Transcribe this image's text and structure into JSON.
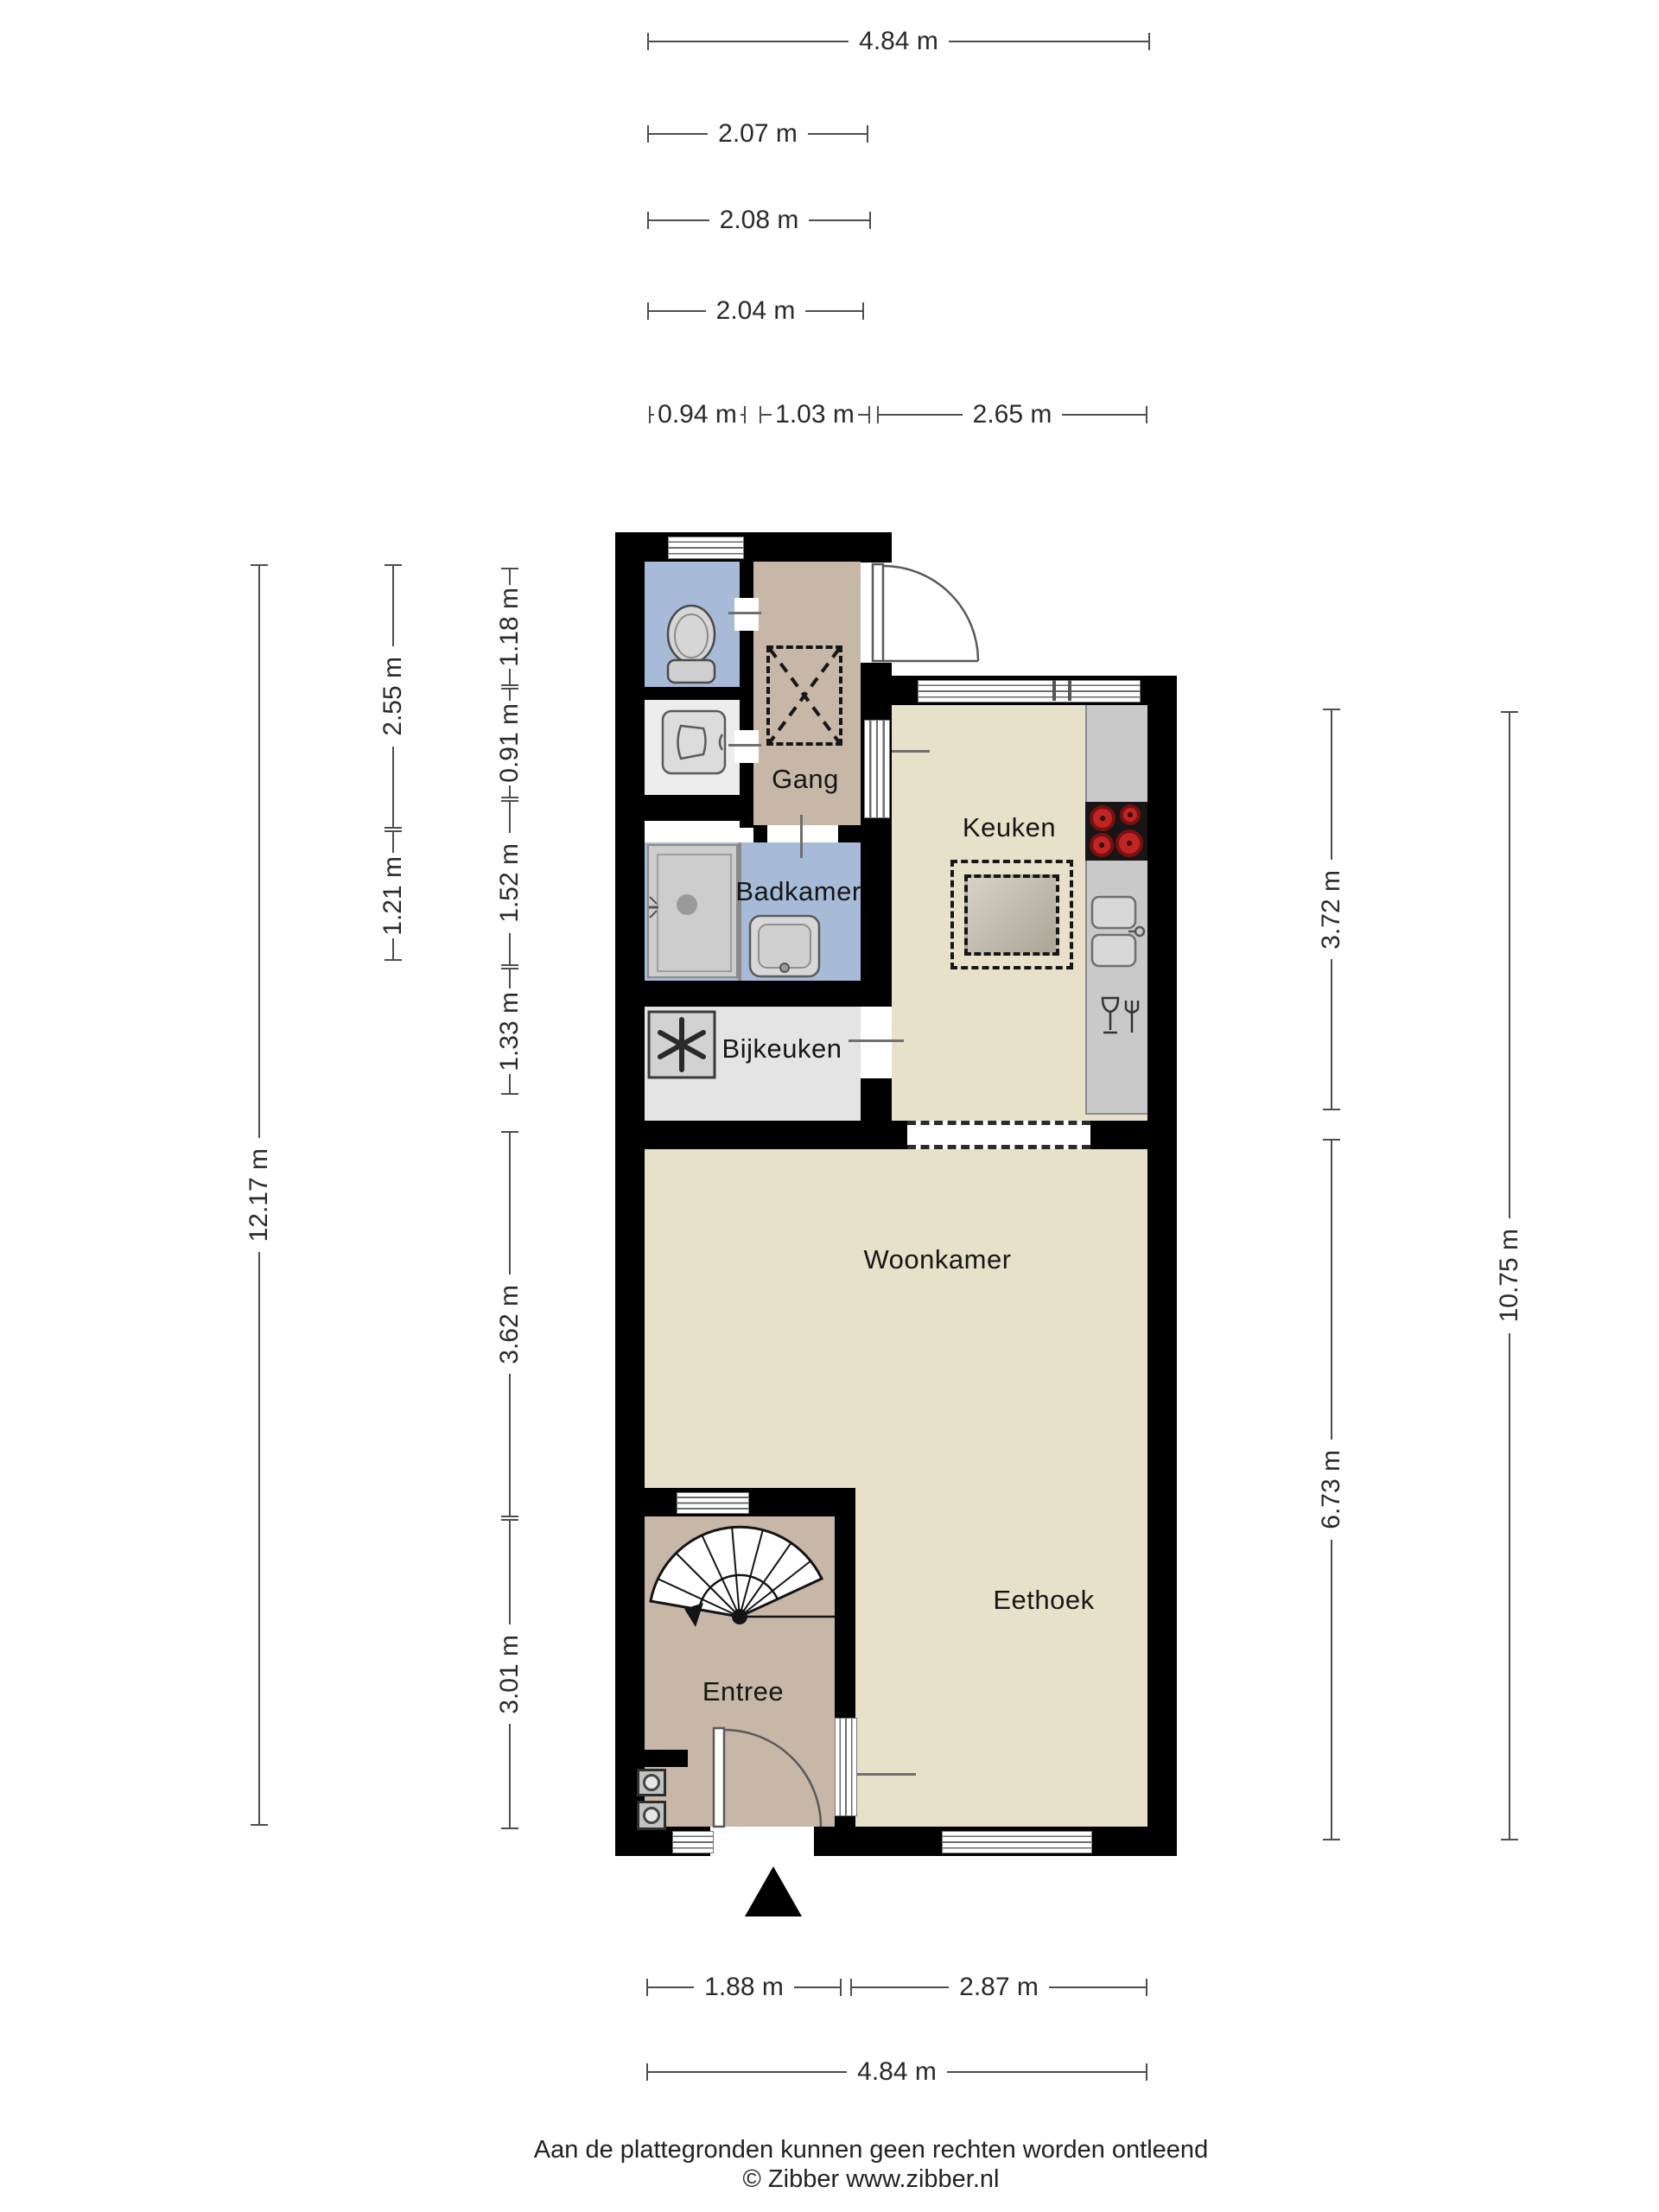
{
  "rooms": {
    "gang": "Gang",
    "keuken": "Keuken",
    "badkamer": "Badkamer",
    "bijkeuken": "Bijkeuken",
    "woonkamer": "Woonkamer",
    "eethoek": "Eethoek",
    "entree": "Entree"
  },
  "dimensions": {
    "top": [
      "4.84 m",
      "2.07 m",
      "2.08 m",
      "2.04 m",
      "0.94 m",
      "1.03 m",
      "2.65 m"
    ],
    "bottom": [
      "1.88 m",
      "2.87 m",
      "4.84 m"
    ],
    "left": [
      "12.17 m",
      "2.55 m",
      "1.21 m",
      "1.18 m",
      "0.91 m",
      "1.52 m",
      "1.33 m",
      "3.62 m",
      "3.01 m"
    ],
    "right": [
      "3.72 m",
      "6.73 m",
      "10.75 m"
    ]
  },
  "footer": {
    "disclaimer": "Aan de plattegronden kunnen geen rechten worden ontleend",
    "credit": "© Zibber www.zibber.nl"
  },
  "colors": {
    "wall": "#000000",
    "hall_floor": "#c7b7a7",
    "wet_floor": "#a7bad8",
    "living_floor": "#e8e1c9",
    "utility_floor": "#e4e4e4",
    "washroom_floor": "#ededed",
    "counter": "#c9c9c9",
    "burner_red": "#c22424",
    "dim_line": "#4d4d4d"
  },
  "icons": [
    "toilet-icon",
    "washbasin-icon",
    "shower-icon",
    "bathroom-sink-icon",
    "fan-icon",
    "cooktop-icon",
    "kitchen-sink-icon",
    "dishwasher-icon",
    "spiral-staircase-icon",
    "door-swing-icon",
    "entrance-arrow-icon",
    "meter-icon",
    "vide-dashed-icon",
    "open-connection"
  ]
}
